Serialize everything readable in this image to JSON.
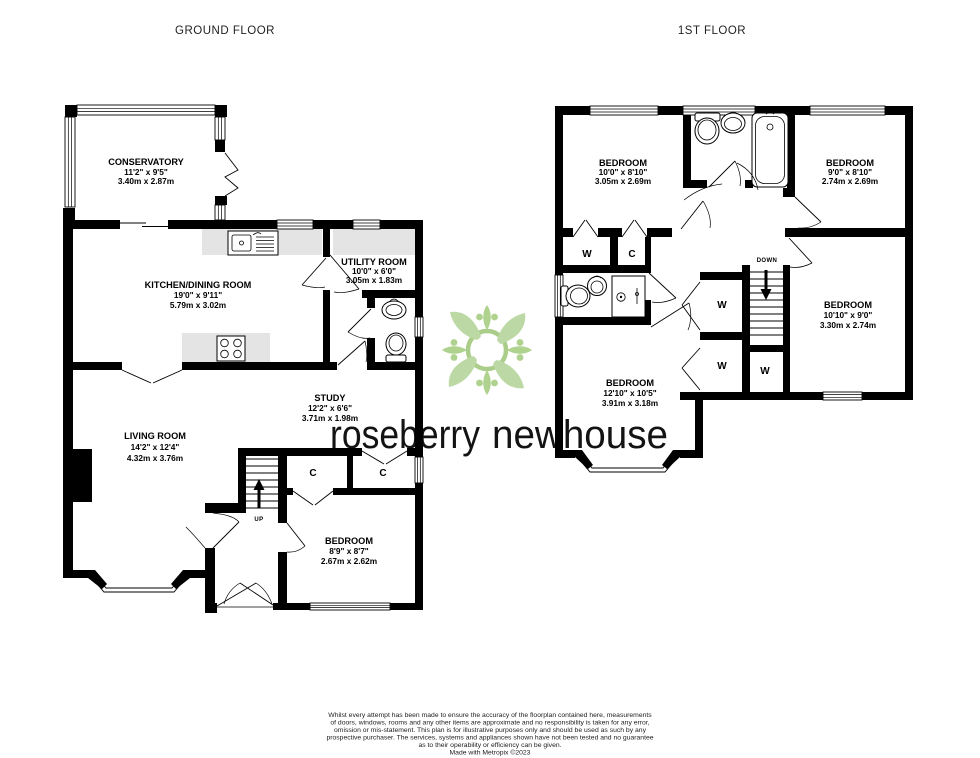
{
  "titles": {
    "ground": "GROUND FLOOR",
    "first": "1ST FLOOR"
  },
  "ground_floor": {
    "rooms": [
      {
        "id": "conservatory",
        "name": "CONSERVATORY",
        "imperial": "11'2\" x 9'5\"",
        "metric": "3.40m x 2.87m"
      },
      {
        "id": "kitchen_dining",
        "name": "KITCHEN/DINING ROOM",
        "imperial": "19'0\" x 9'11\"",
        "metric": "5.79m x 3.02m"
      },
      {
        "id": "utility_room",
        "name": "UTILITY ROOM",
        "imperial": "10'0\" x 6'0\"",
        "metric": "3.05m x 1.83m"
      },
      {
        "id": "living_room",
        "name": "LIVING ROOM",
        "imperial": "14'2\" x 12'4\"",
        "metric": "4.32m x 3.76m"
      },
      {
        "id": "study",
        "name": "STUDY",
        "imperial": "12'2\" x 6'6\"",
        "metric": "3.71m x 1.98m"
      },
      {
        "id": "bedroom",
        "name": "BEDROOM",
        "imperial": "8'9\" x 8'7\"",
        "metric": "2.67m x 2.62m"
      }
    ],
    "closet_labels": [
      "C",
      "C"
    ],
    "stair_label": "UP"
  },
  "first_floor": {
    "rooms": [
      {
        "id": "bedroom1",
        "name": "BEDROOM",
        "imperial": "10'0\" x 8'10\"",
        "metric": "3.05m x 2.69m"
      },
      {
        "id": "bedroom2",
        "name": "BEDROOM",
        "imperial": "9'0\" x 8'10\"",
        "metric": "2.74m x 2.69m"
      },
      {
        "id": "bedroom3",
        "name": "BEDROOM",
        "imperial": "10'10\" x 9'0\"",
        "metric": "3.30m x 2.74m"
      },
      {
        "id": "bedroom4",
        "name": "BEDROOM",
        "imperial": "12'10\" x 10'5\"",
        "metric": "3.91m x 3.18m"
      }
    ],
    "closet_labels": [
      "W",
      "C",
      "W",
      "W",
      "W"
    ],
    "stair_label": "DOWN"
  },
  "logo": {
    "word_gray": "roseberry",
    "word_green": "newhouse"
  },
  "footer": {
    "disclaimer_lines": [
      "Whilst every attempt has been made to ensure the accuracy of the floorplan contained here, measurements",
      "of doors, windows, rooms and any other items are approximate and no responsibility is taken for any error,",
      "omission or mis-statement. This plan is for illustrative purposes only and should be used as such by any",
      "prospective purchaser. The services, systems and appliances shown have not been tested and no guarantee",
      "as to their operability or efficiency can be given."
    ],
    "credit": "Made with Metropix ©2023"
  },
  "colors": {
    "wall": "#000000",
    "counter": "#e4e4e4",
    "logo_green": "#a7cb7b",
    "logo_gray": "#97979a",
    "logo_leaf": "#b7d69e"
  }
}
